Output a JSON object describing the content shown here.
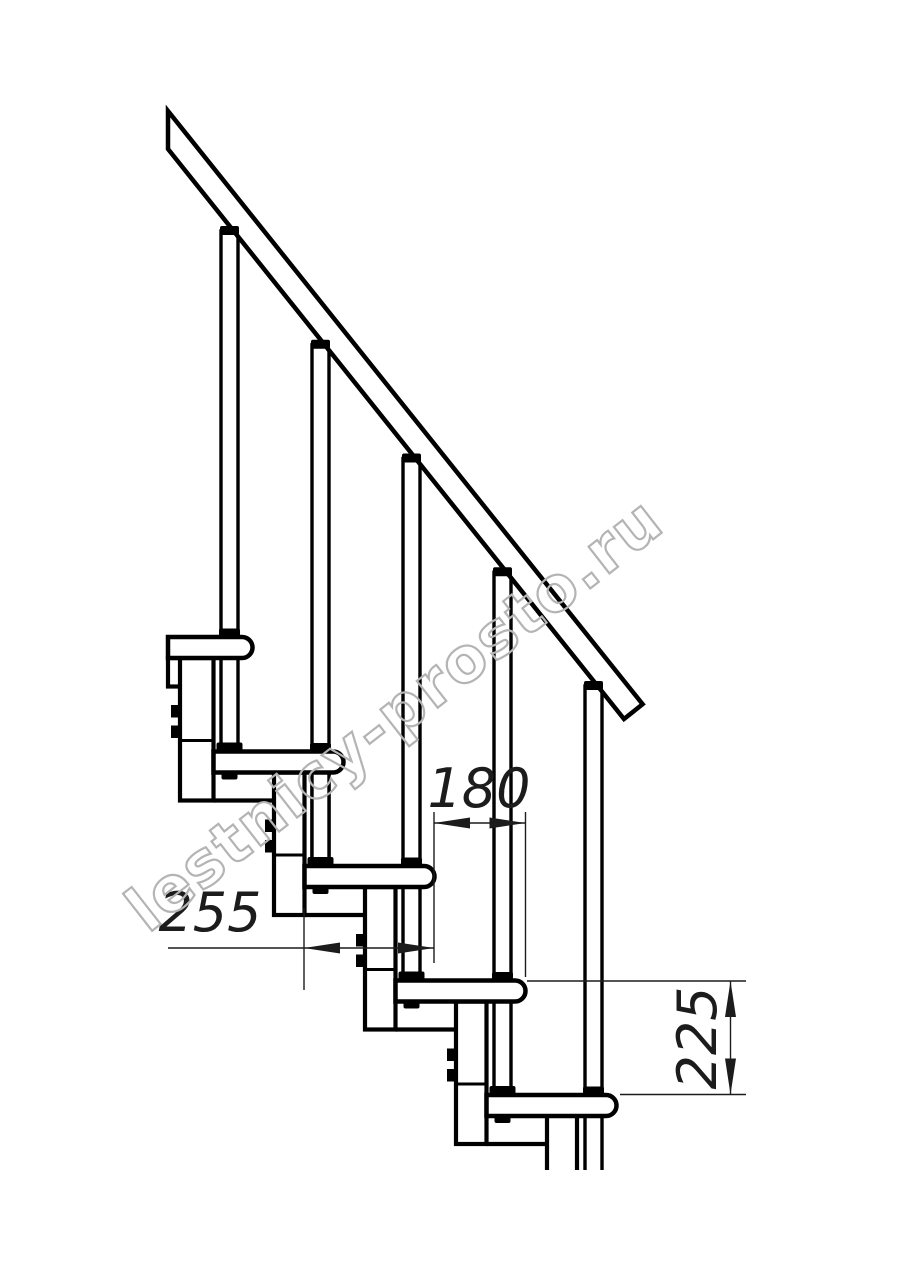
{
  "page": {
    "background": "#ffffff"
  },
  "drawing": {
    "type": "staircase-module-side-view-technical-drawing",
    "watermark": "lestnicy-prosto.ru",
    "dimensions": {
      "tread_overlap": "180",
      "tread_depth": "255",
      "step_height": "225"
    },
    "colors": {
      "line": "#000000",
      "dimension": "#1c1c1c",
      "watermark": "#b4b4b4",
      "background": "#ffffff"
    },
    "counts": {
      "treads": 5,
      "balusters": 5,
      "support_columns": 5
    }
  }
}
